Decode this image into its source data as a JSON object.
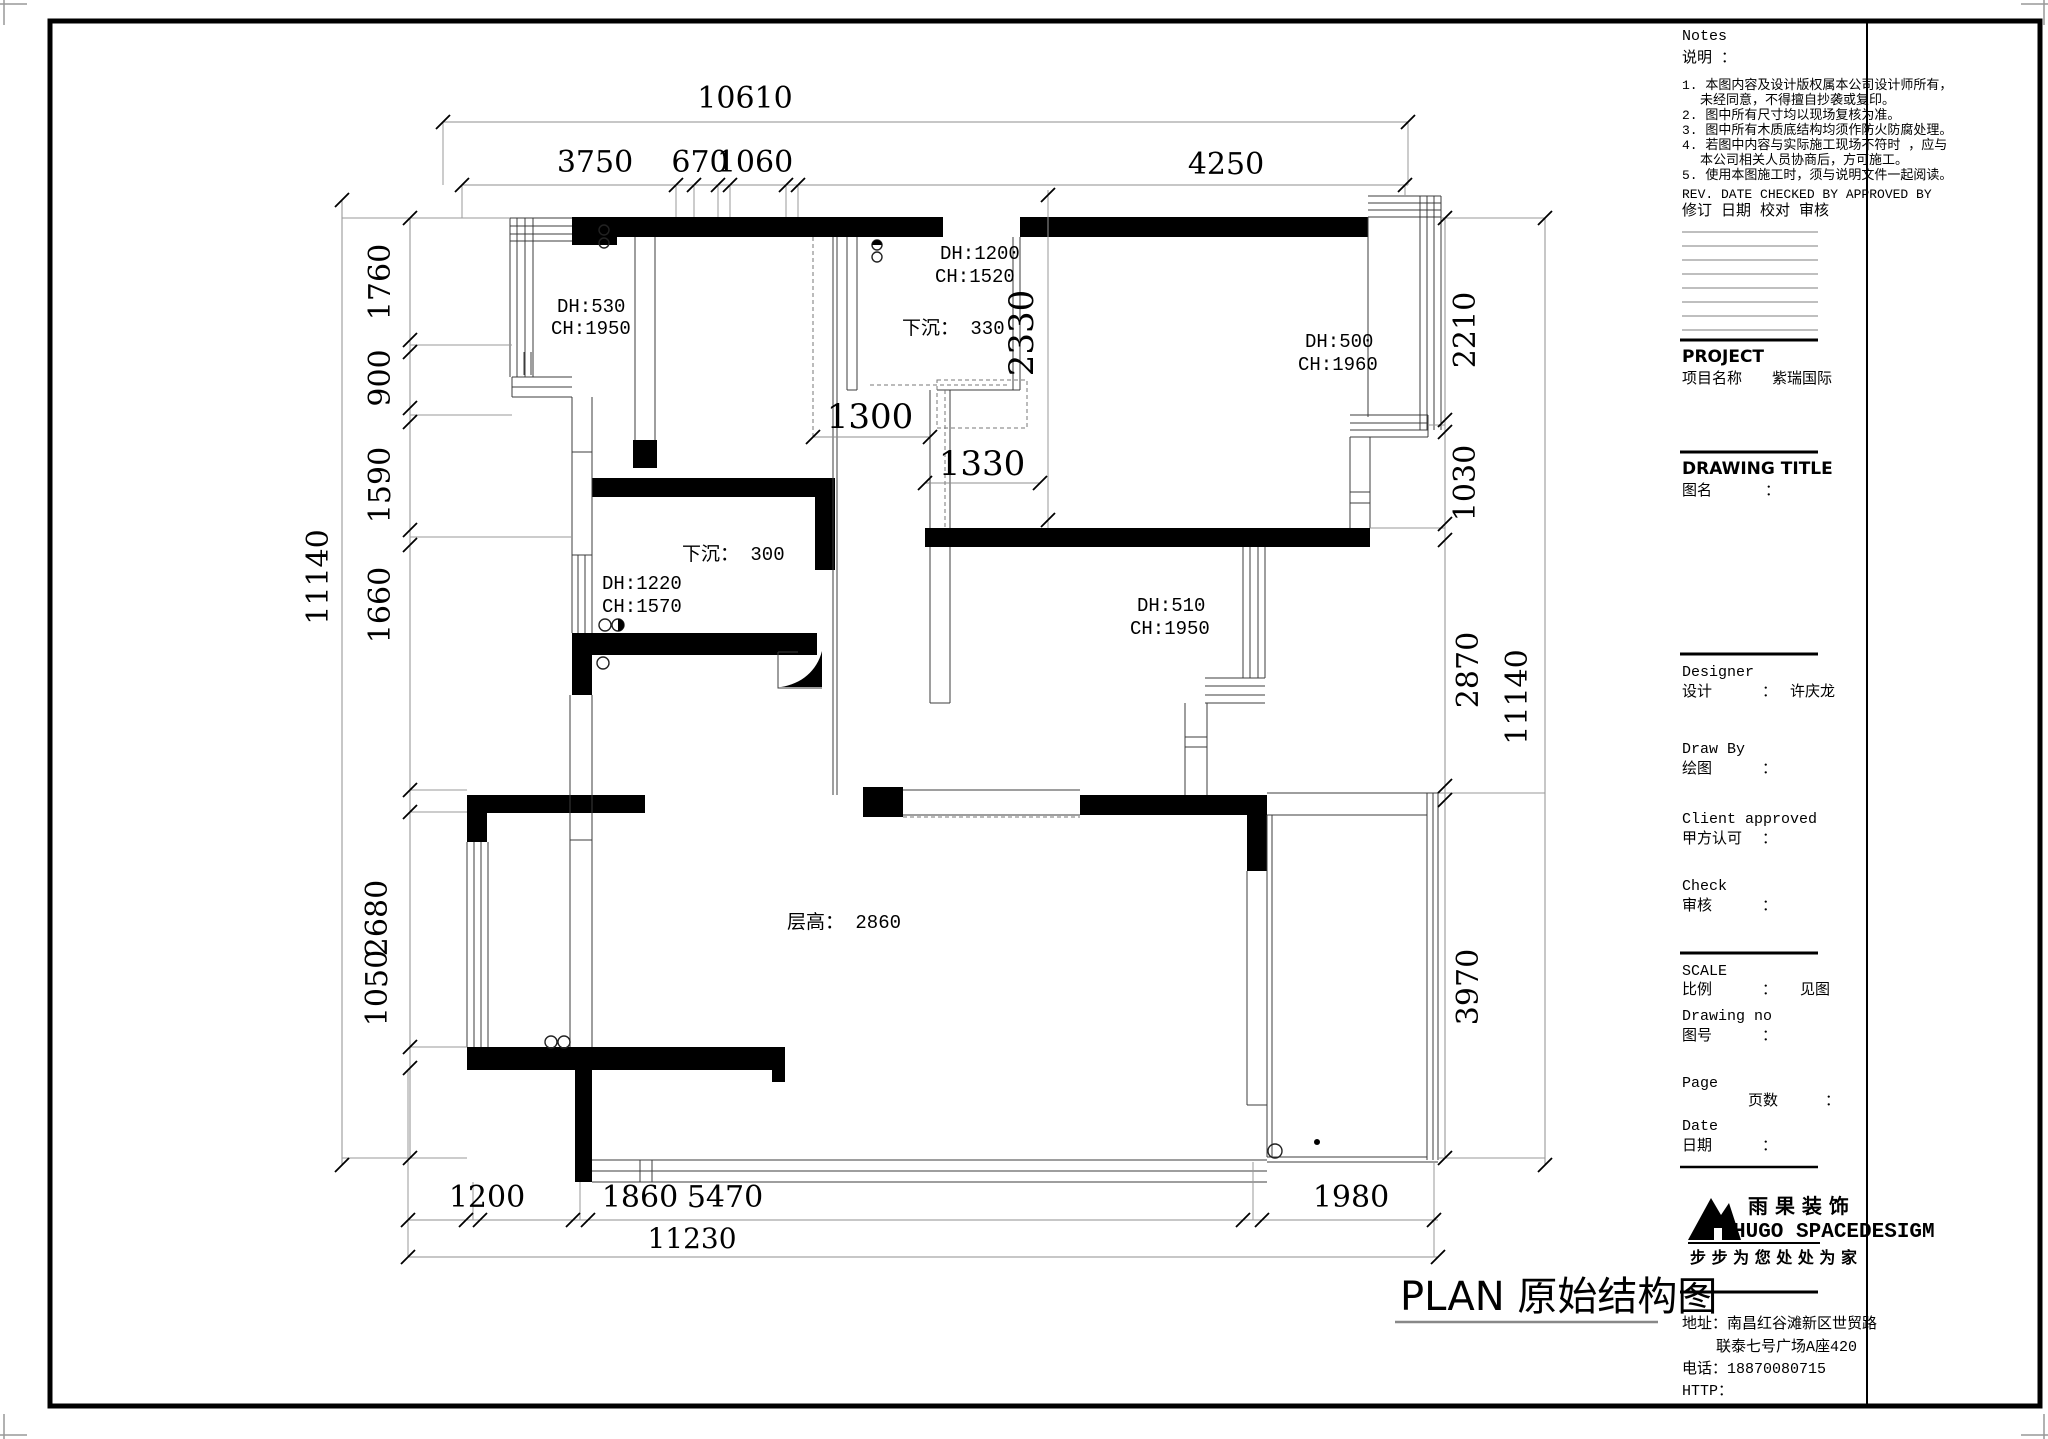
{
  "plan_title": "PLAN  原始结构图",
  "dims": {
    "top_total": "10610",
    "top": [
      "3750",
      "670",
      "1060",
      "4250"
    ],
    "left_total": "11140",
    "left": [
      "1760",
      "900",
      "1590",
      "1660",
      "2680",
      "1050"
    ],
    "right_total": "11140",
    "right": [
      "2210",
      "1030",
      "2870",
      "3970"
    ],
    "bottom_total": "11230",
    "bottom": [
      "1200",
      "1860",
      "5470",
      "1980"
    ],
    "interior": {
      "d2330": "2330",
      "d1300": "1300",
      "d1330": "1330"
    }
  },
  "labels": {
    "dh530": "DH:530",
    "ch1950a": "CH:1950",
    "dh1200": "DH:1200",
    "ch1520": "CH:1520",
    "sunk330": "下沉：  330",
    "dh500": "DH:500",
    "ch1960": "CH:1960",
    "sunk300": "下沉：  300",
    "dh1220": "DH:1220",
    "ch1570": "CH:1570",
    "dh510": "DH:510",
    "ch1950b": "CH:1950",
    "floor_height": "层高：  2860"
  },
  "title_block": {
    "notes_en": "Notes",
    "notes_zh": "说明 ：",
    "notes": [
      "1. 本图内容及设计版权属本公司设计师所有，",
      "未经同意，不得擅自抄袭或复印。",
      "2. 图中所有尺寸均以现场复核为准。",
      "3. 图中所有木质底结构均须作防火防腐处理。",
      "4. 若图中内容与实际施工现场不符时 ，应与",
      "本公司相关人员协商后，方可施工。",
      "5. 使用本图施工时，须与说明文件一起阅读。"
    ],
    "rev_en": "REV. DATE CHECKED BY  APPROVED BY",
    "rev_zh": "修订 日期      校对        审核",
    "project_en": "PROJECT",
    "project_zh": "项目名称",
    "project_name": "紫瑞国际",
    "drawing_title_en": "DRAWING  TITLE",
    "drawing_title_zh": "图名",
    "colon": "：",
    "designer_en": "Designer",
    "designer_zh": "设计",
    "designer_value": "许庆龙",
    "draw_by_en": "Draw By",
    "draw_by_zh": "绘图",
    "client_en": "Client approved",
    "client_zh": "甲方认可",
    "check_en": "Check",
    "check_zh": "审核",
    "scale_en": "SCALE",
    "scale_zh": "比例",
    "scale_value": "见图",
    "drawing_no_en": "Drawing  no",
    "drawing_no_zh": "图号",
    "page_en": "Page",
    "page_zh": "页数",
    "date_en": "Date",
    "date_zh": "日期",
    "brand_zh": "雨 果 装 饰",
    "brand_en": "HUGO SPACEDESIGM",
    "slogan": "步 步 为 您   处 处 为 家",
    "address1": "地址：南昌红谷滩新区世贸路",
    "address2": "联泰七号广场A座420",
    "phone": "电话：18870080715",
    "http": "HTTP："
  }
}
